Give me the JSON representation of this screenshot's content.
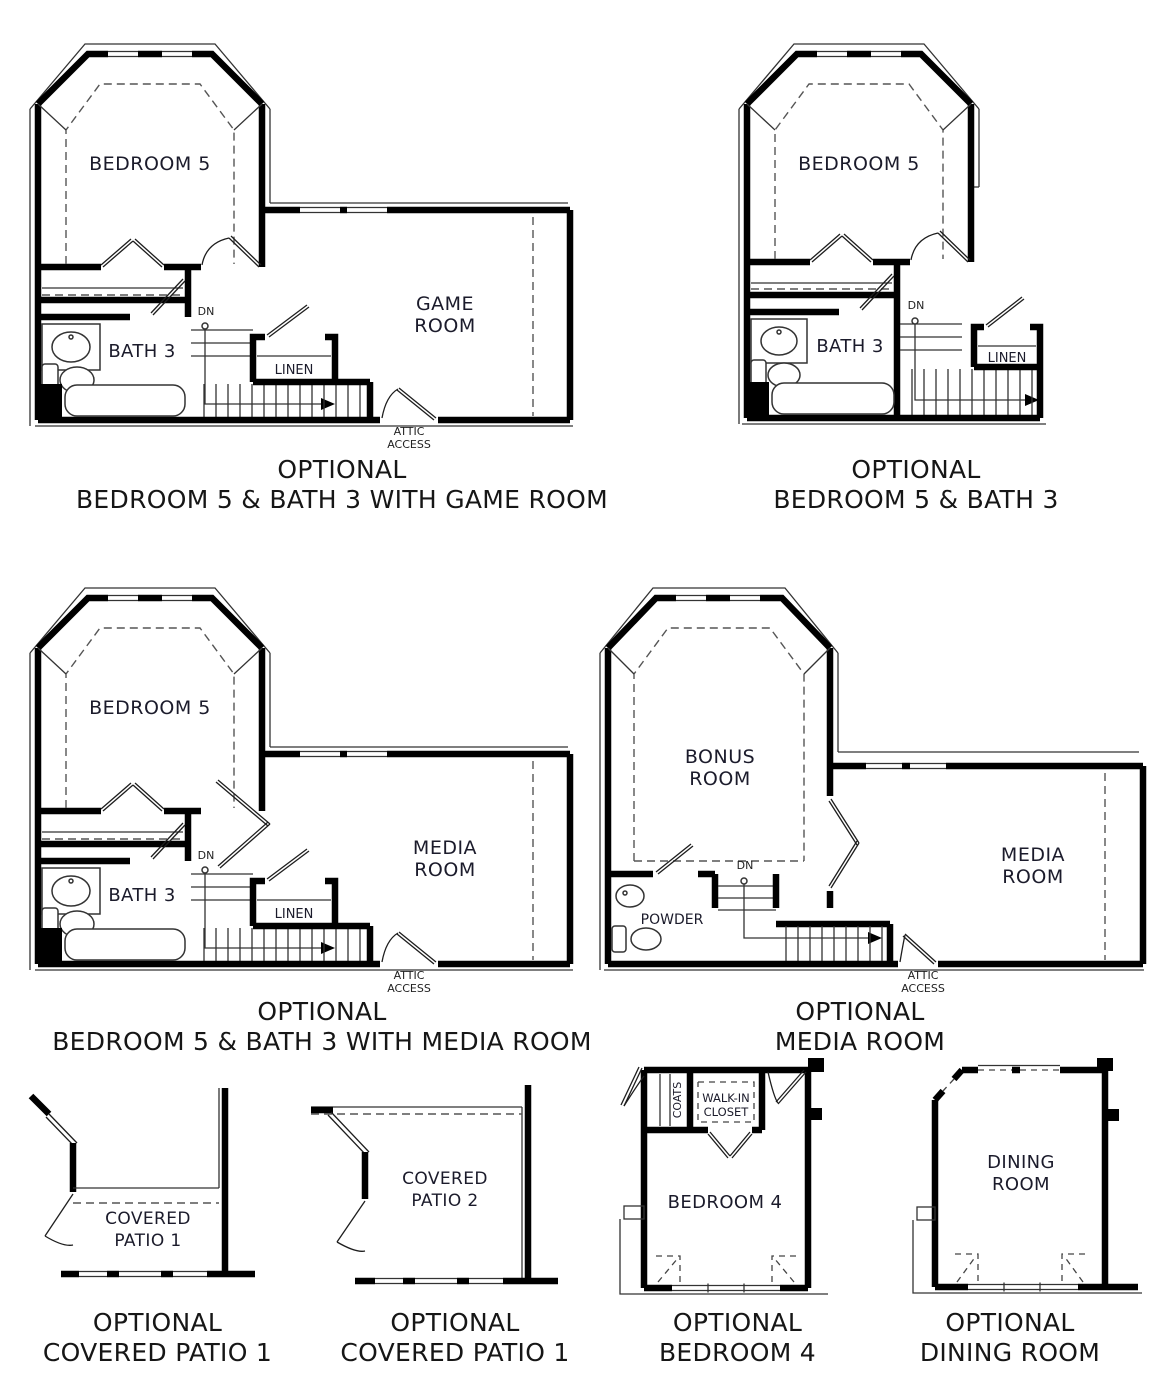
{
  "page": {
    "background": "#ffffff",
    "wall_ink": "#000000",
    "text_color": "#1b1b2b"
  },
  "plans": [
    {
      "id": "bedroom5-bath3-game-room",
      "caption": [
        "OPTIONAL",
        "BEDROOM 5 & BATH 3 WITH GAME ROOM"
      ],
      "labels": {
        "bedroom": "BEDROOM 5",
        "room1": "GAME",
        "room2": "ROOM",
        "bath": "BATH 3",
        "linen": "LINEN",
        "dn": "DN",
        "attic1": "ATTIC",
        "attic2": "ACCESS"
      }
    },
    {
      "id": "bedroom5-bath3",
      "caption": [
        "OPTIONAL",
        "BEDROOM 5 & BATH 3"
      ],
      "labels": {
        "bedroom": "BEDROOM 5",
        "bath": "BATH 3",
        "linen": "LINEN",
        "dn": "DN"
      }
    },
    {
      "id": "bedroom5-bath3-media-room",
      "caption": [
        "OPTIONAL",
        "BEDROOM 5 & BATH 3 WITH MEDIA ROOM"
      ],
      "labels": {
        "bedroom": "BEDROOM 5",
        "room1": "MEDIA",
        "room2": "ROOM",
        "bath": "BATH 3",
        "linen": "LINEN",
        "dn": "DN",
        "attic1": "ATTIC",
        "attic2": "ACCESS"
      }
    },
    {
      "id": "media-room",
      "caption": [
        "OPTIONAL",
        "MEDIA ROOM"
      ],
      "labels": {
        "bonus1": "BONUS",
        "bonus2": "ROOM",
        "room1": "MEDIA",
        "room2": "ROOM",
        "powder": "POWDER",
        "dn": "DN",
        "attic1": "ATTIC",
        "attic2": "ACCESS"
      }
    },
    {
      "id": "covered-patio-1",
      "caption": [
        "OPTIONAL",
        "COVERED PATIO 1"
      ],
      "labels": {
        "room1": "COVERED",
        "room2": "PATIO 1"
      }
    },
    {
      "id": "covered-patio-2",
      "caption": [
        "OPTIONAL",
        "COVERED PATIO 1"
      ],
      "labels": {
        "room1": "COVERED",
        "room2": "PATIO 2"
      }
    },
    {
      "id": "bedroom-4",
      "caption": [
        "OPTIONAL",
        "BEDROOM 4"
      ],
      "labels": {
        "bedroom": "BEDROOM 4",
        "coats": "COATS",
        "wic1": "WALK-IN",
        "wic2": "CLOSET"
      }
    },
    {
      "id": "dining-room",
      "caption": [
        "OPTIONAL",
        "DINING ROOM"
      ],
      "labels": {
        "room1": "DINING",
        "room2": "ROOM"
      }
    }
  ]
}
